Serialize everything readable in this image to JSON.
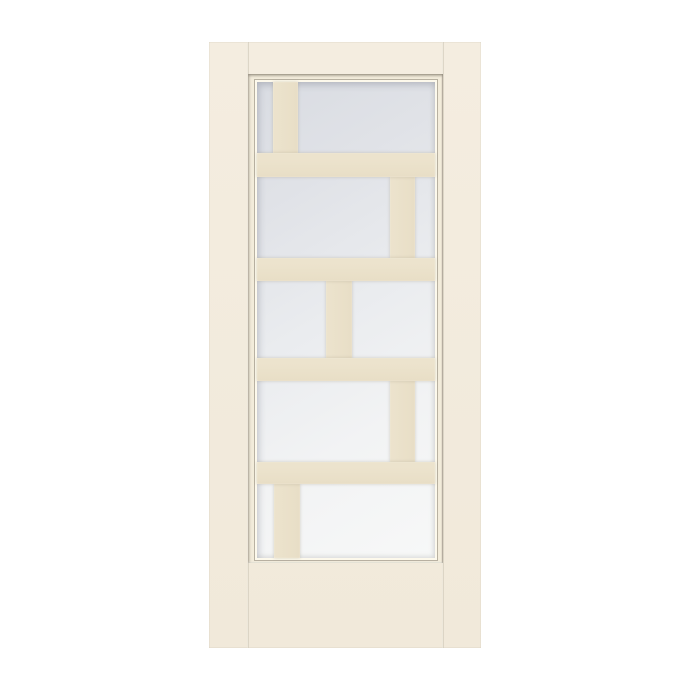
{
  "image_type": "product-render",
  "subject": {
    "name": "interior door with decorative frosted glass",
    "glass_style": "brick-pattern divided lite (5 offset rows)",
    "finish": "cream white",
    "hardware": "none visible",
    "text_content": "none"
  },
  "colors": {
    "background": "#ffffff",
    "door_face": "#f4ede0",
    "door_face_bottom": "#f1e9da",
    "molding_face": "#f3ecdb",
    "molding_highlight": "#fdf9ec",
    "seam_line": "#c9c1af",
    "muntin": "#ece3cd",
    "muntin_dark": "#e8dec6",
    "glass_top": "#d9dce2",
    "glass_mid": "#eaecef",
    "glass_bottom": "#f7f8f8"
  },
  "door": {
    "x": 209,
    "y": 42,
    "width": 272,
    "height": 606,
    "stile_seam_left_x": 39,
    "stile_seam_right_x": 234,
    "glass_frame": {
      "x": 39,
      "y": 32,
      "width": 195,
      "height": 489,
      "molding_thickness": {
        "left": 9,
        "top": 8,
        "right": 8,
        "bottom": 5
      }
    },
    "glass_grid": {
      "rows": 5,
      "glass_width": 178,
      "glass_height": 476,
      "horizontal_bars": [
        {
          "y": 71,
          "h": 24
        },
        {
          "y": 176,
          "h": 23
        },
        {
          "y": 276,
          "h": 23
        },
        {
          "y": 380,
          "h": 22
        }
      ],
      "vertical_bars": [
        {
          "x": 16,
          "w": 25,
          "y": 0,
          "h": 71
        },
        {
          "x": 133,
          "w": 25,
          "y": 95,
          "h": 81
        },
        {
          "x": 69,
          "w": 26,
          "y": 199,
          "h": 77
        },
        {
          "x": 133,
          "w": 25,
          "y": 299,
          "h": 81
        },
        {
          "x": 17,
          "w": 26,
          "y": 402,
          "h": 74
        }
      ]
    }
  }
}
